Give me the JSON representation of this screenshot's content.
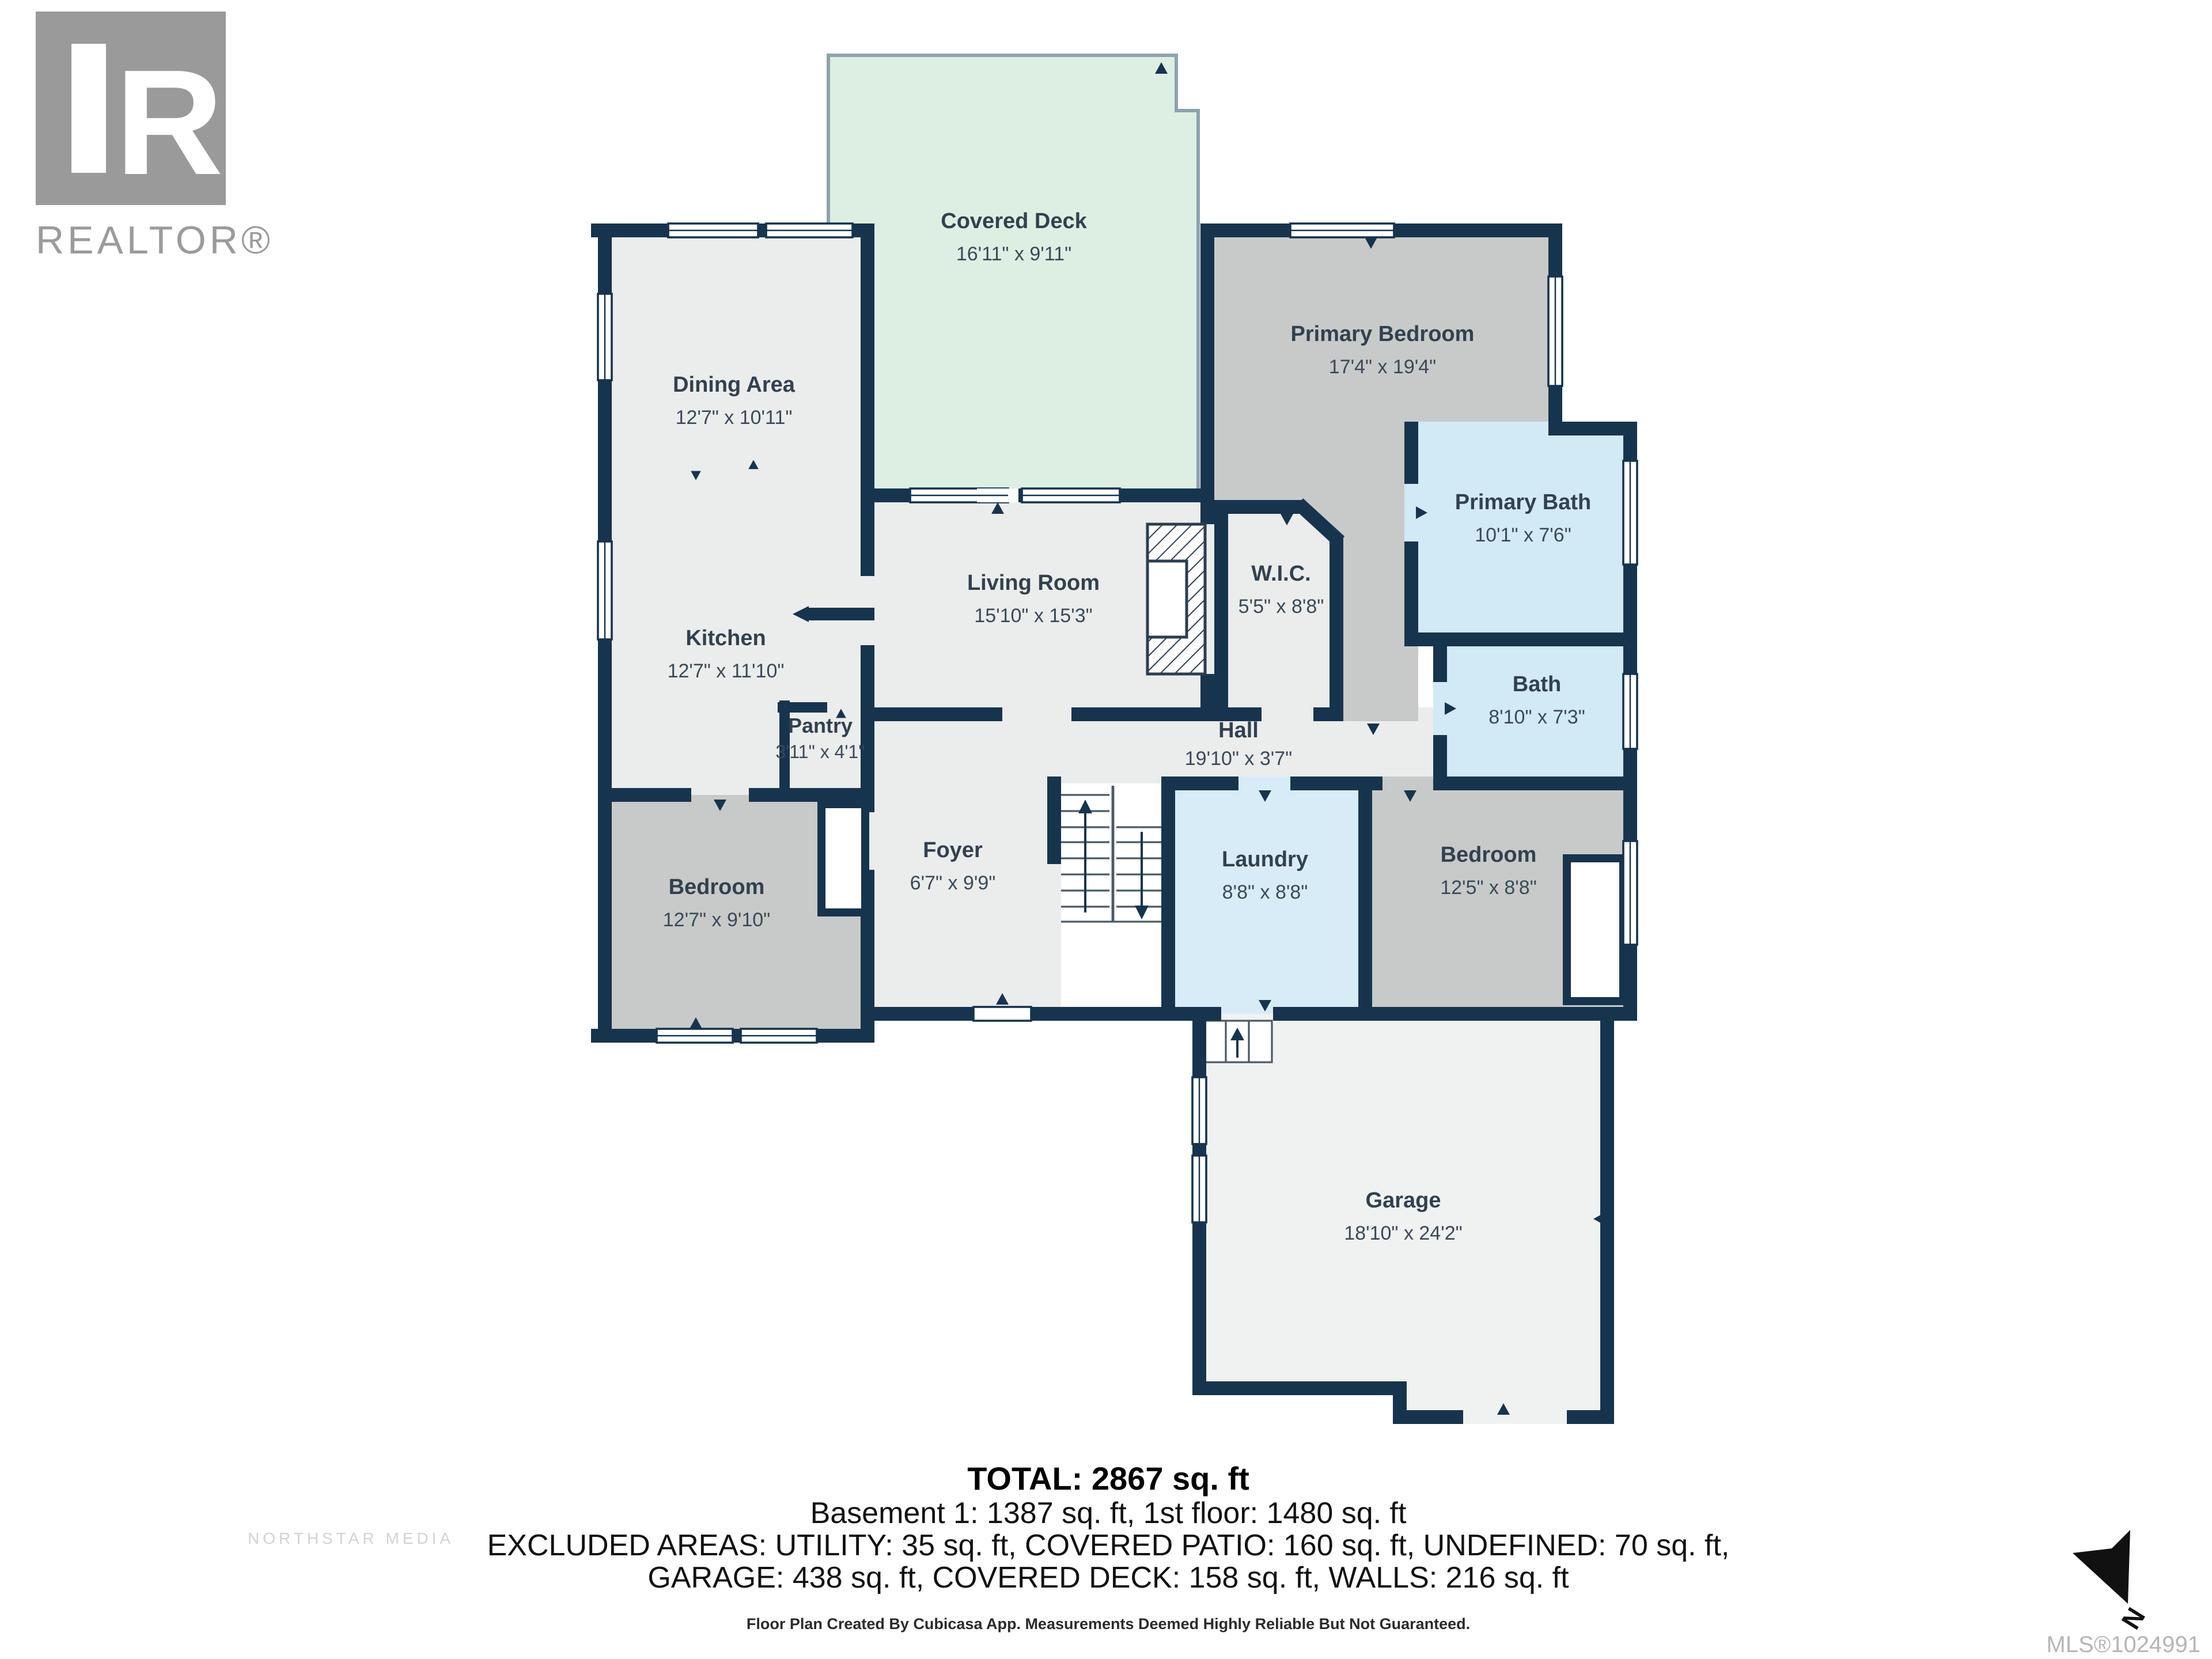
{
  "branding": {
    "logo_letter": "R",
    "logo_text": "REALTOR®",
    "watermark_line": "NORTHSTAR MEDIA",
    "mls_number": "MLS®1024991",
    "north_label": "N"
  },
  "rooms": {
    "covered_deck": {
      "label": "Covered Deck",
      "dims": "16'11\" x 9'11\""
    },
    "dining_area": {
      "label": "Dining Area",
      "dims": "12'7\" x 10'11\""
    },
    "kitchen": {
      "label": "Kitchen",
      "dims": "12'7\" x 11'10\""
    },
    "pantry": {
      "label": "Pantry",
      "dims": "3'11\" x 4'1\""
    },
    "living_room": {
      "label": "Living Room",
      "dims": "15'10\" x 15'3\""
    },
    "primary_bedroom": {
      "label": "Primary Bedroom",
      "dims": "17'4\" x 19'4\""
    },
    "primary_bath": {
      "label": "Primary Bath",
      "dims": "10'1\" x 7'6\""
    },
    "wic": {
      "label": "W.I.C.",
      "dims": "5'5\" x 8'8\""
    },
    "hall": {
      "label": "Hall",
      "dims": "19'10\" x 3'7\""
    },
    "bath": {
      "label": "Bath",
      "dims": "8'10\" x 7'3\""
    },
    "bedroom_left": {
      "label": "Bedroom",
      "dims": "12'7\" x 9'10\""
    },
    "foyer": {
      "label": "Foyer",
      "dims": "6'7\" x 9'9\""
    },
    "laundry": {
      "label": "Laundry",
      "dims": "8'8\" x 8'8\""
    },
    "bedroom_right": {
      "label": "Bedroom",
      "dims": "12'5\" x 8'8\""
    },
    "garage": {
      "label": "Garage",
      "dims": "18'10\" x 24'2\""
    }
  },
  "summary": {
    "total": "TOTAL: 2867 sq. ft",
    "floors": "Basement 1: 1387 sq. ft, 1st floor: 1480 sq. ft",
    "excluded_line1": "EXCLUDED AREAS: UTILITY: 35 sq. ft, COVERED PATIO: 160 sq. ft, UNDEFINED: 70 sq. ft,",
    "excluded_line2": "GARAGE: 438 sq. ft, COVERED DECK: 158 sq. ft, WALLS: 216 sq. ft",
    "disclaimer": "Floor Plan Created By Cubicasa App. Measurements Deemed Highly Reliable But Not Guaranteed."
  },
  "colors": {
    "wall": "#17344e",
    "floor_light": "#ebecec",
    "floor_gray": "#c8cac9",
    "floor_blue": "#d2e9f6",
    "deck_green": "#ddefe3",
    "garage_floor": "#f0f1f1"
  }
}
